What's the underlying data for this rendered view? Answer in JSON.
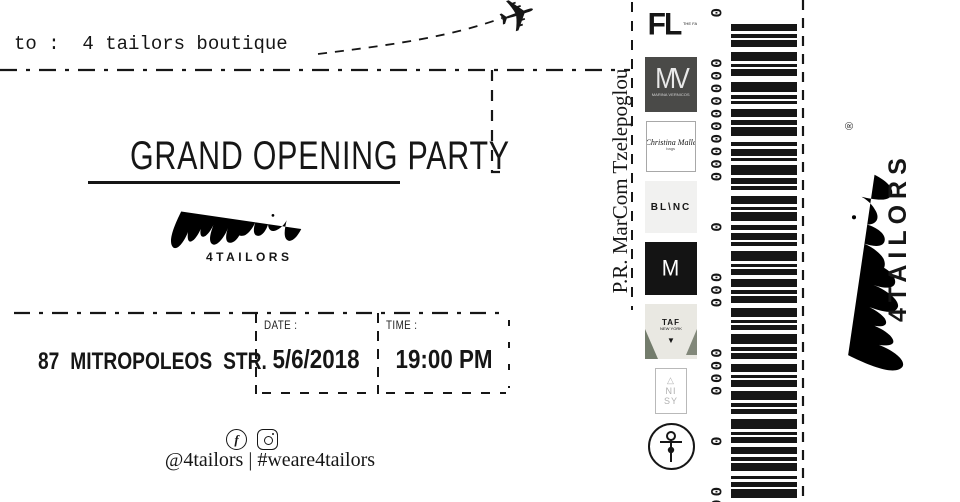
{
  "colors": {
    "ink": "#161616",
    "paper": "#ffffff",
    "mv-bg": "#4a4a48",
    "blanc-bg": "#f1f1f0",
    "m-bg": "#141414",
    "taf-bg": "#e9e8e2",
    "taf-leaf": "#55604f",
    "muted": "#b0b0b0"
  },
  "ticket": {
    "to_line": "to :  4 tailors boutique",
    "plane_icon": "✈",
    "title": "GRAND OPENING PARTY",
    "brand_name": "4TAILORS",
    "address": "87 MITROPOLEOS STR.",
    "date_label": "DATE :",
    "date_value": "5/6/2018",
    "time_label": "TIME :",
    "time_value": "19:00 PM",
    "social_icons": [
      "facebook-icon",
      "instagram-icon"
    ],
    "social_handles": "@4tailors | #weare4tailors"
  },
  "pr_credit": "P.R. MarCom Tzelepoglou",
  "sponsors": [
    {
      "id": "fl",
      "label": "FL",
      "sub": "THE FASHION LAB"
    },
    {
      "id": "mv",
      "label": "MV",
      "sub": "MARINA VERNICOS"
    },
    {
      "id": "cm",
      "label": "Christina Malle",
      "sub": "bags"
    },
    {
      "id": "blanc",
      "label": "BL\\NC"
    },
    {
      "id": "m",
      "label": "M"
    },
    {
      "id": "taf",
      "label": "TAF",
      "sub": "NEW YORK",
      "mark": "▼"
    },
    {
      "id": "anisy",
      "lines": [
        "△",
        "NI",
        "SY"
      ]
    },
    {
      "id": "needle",
      "icon": "needle-pin-icon"
    }
  ],
  "barcode": {
    "digit_groups": [
      "0",
      "0000000000",
      "0",
      "000",
      "0000",
      "0",
      "00000000000"
    ],
    "bars": [
      [
        7,
        3
      ],
      [
        4,
        2
      ],
      [
        7,
        5
      ],
      [
        9,
        3
      ],
      [
        3,
        2
      ],
      [
        7,
        6
      ],
      [
        10,
        3
      ],
      [
        4,
        2
      ],
      [
        3,
        5
      ],
      [
        8,
        3
      ],
      [
        5,
        2
      ],
      [
        9,
        6
      ],
      [
        4,
        3
      ],
      [
        7,
        2
      ],
      [
        3,
        4
      ],
      [
        10,
        3
      ],
      [
        6,
        2
      ],
      [
        4,
        6
      ],
      [
        8,
        3
      ],
      [
        3,
        2
      ],
      [
        9,
        4
      ],
      [
        5,
        3
      ],
      [
        7,
        2
      ],
      [
        4,
        5
      ],
      [
        10,
        3
      ],
      [
        3,
        2
      ],
      [
        6,
        4
      ],
      [
        8,
        3
      ],
      [
        4,
        2
      ],
      [
        7,
        5
      ],
      [
        9,
        3
      ],
      [
        3,
        2
      ],
      [
        5,
        4
      ],
      [
        10,
        3
      ],
      [
        4,
        2
      ],
      [
        6,
        5
      ],
      [
        8,
        3
      ],
      [
        3,
        2
      ],
      [
        7,
        4
      ],
      [
        9,
        3
      ],
      [
        4,
        2
      ],
      [
        5,
        5
      ],
      [
        10,
        3
      ],
      [
        3,
        2
      ],
      [
        6,
        4
      ],
      [
        7,
        3
      ],
      [
        4,
        2
      ],
      [
        8,
        5
      ],
      [
        3,
        3
      ],
      [
        5,
        2
      ],
      [
        9,
        4
      ],
      [
        4,
        3
      ]
    ]
  },
  "stub": {
    "brand_name": "4TAILORS",
    "registered": "®"
  }
}
